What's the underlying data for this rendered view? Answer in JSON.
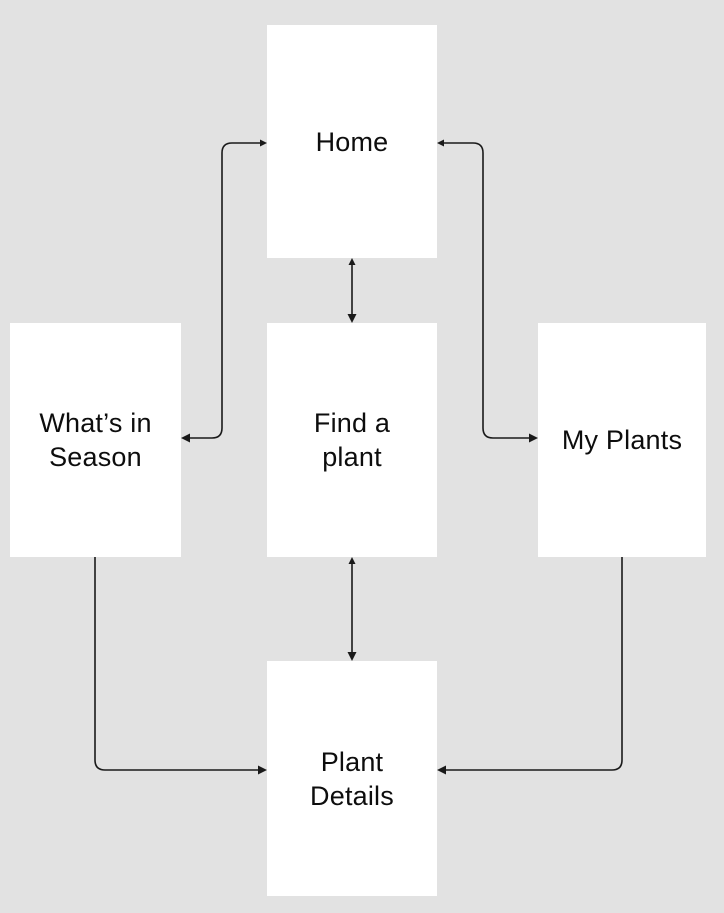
{
  "diagram": {
    "colors": {
      "background": "#e2e2e2",
      "node_fill": "#ffffff",
      "connector": "#1a1a1a",
      "text": "#0d0d0d"
    },
    "nodes": [
      {
        "id": "home",
        "label": "Home",
        "lines": [
          "Home"
        ]
      },
      {
        "id": "whats-in-season",
        "label": "What’s in Season",
        "lines": [
          "What’s in",
          "Season"
        ]
      },
      {
        "id": "find-a-plant",
        "label": "Find a plant",
        "lines": [
          "Find a",
          "plant"
        ]
      },
      {
        "id": "my-plants",
        "label": "My Plants",
        "lines": [
          "My Plants"
        ]
      },
      {
        "id": "plant-details",
        "label": "Plant Details",
        "lines": [
          "Plant",
          "Details"
        ]
      }
    ],
    "edges": [
      {
        "from": "Home",
        "to": "What’s in Season",
        "arrow": "both"
      },
      {
        "from": "Home",
        "to": "Find a plant",
        "arrow": "both"
      },
      {
        "from": "Home",
        "to": "My Plants",
        "arrow": "both"
      },
      {
        "from": "Find a plant",
        "to": "Plant Details",
        "arrow": "both"
      },
      {
        "from": "What’s in Season",
        "to": "Plant Details",
        "arrow": "forward"
      },
      {
        "from": "My Plants",
        "to": "Plant Details",
        "arrow": "forward"
      }
    ]
  }
}
